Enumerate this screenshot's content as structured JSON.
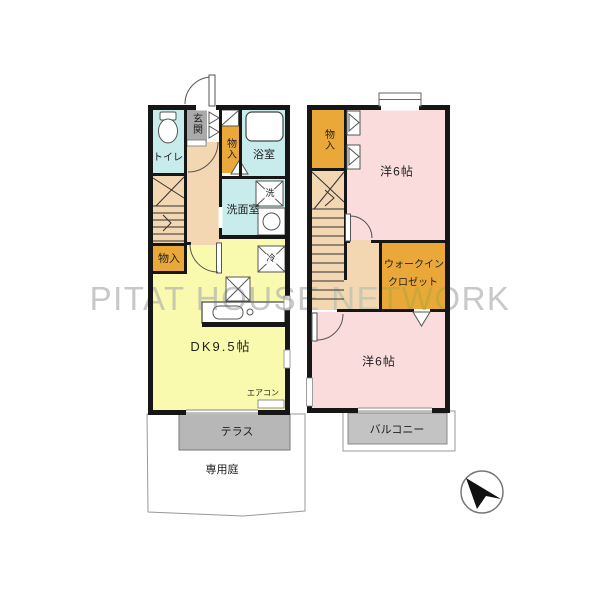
{
  "watermark": {
    "text": "PITAT HOUSE NETWORK"
  },
  "floor1": {
    "toilet": "トイレ",
    "entrance": "玄関",
    "storage_upper": "物入",
    "bathroom": "浴室",
    "washing_machine": "洗",
    "washroom": "洗面室",
    "storage_lower": "物入",
    "refrigerator": "冷",
    "dining_kitchen": "DK9.5帖",
    "air_conditioner": "エアコン",
    "terrace": "テラス",
    "private_garden": "専用庭"
  },
  "floor2": {
    "storage": "物入",
    "bedroom_upper": "洋6帖",
    "walk_in_closet_line1": "ウォークイン",
    "walk_in_closet_line2": "クロゼット",
    "bedroom_lower": "洋6帖",
    "balcony": "バルコニー"
  },
  "compass": {
    "direction": "north-upper-left"
  },
  "colors": {
    "wall": "#161616",
    "water_blue": "#c8ebeb",
    "storage_orange": "#eaa839",
    "hall_beige": "#f3d6b2",
    "kitchen_yellow": "#fafaae",
    "bedroom_pink": "#f9dcdb",
    "terrace_gray": "#b7b7b7",
    "balcony_gray": "#c3c3c3",
    "entrance_gray": "#aaaaaa",
    "watermark_gray": "#c8c8c8"
  }
}
